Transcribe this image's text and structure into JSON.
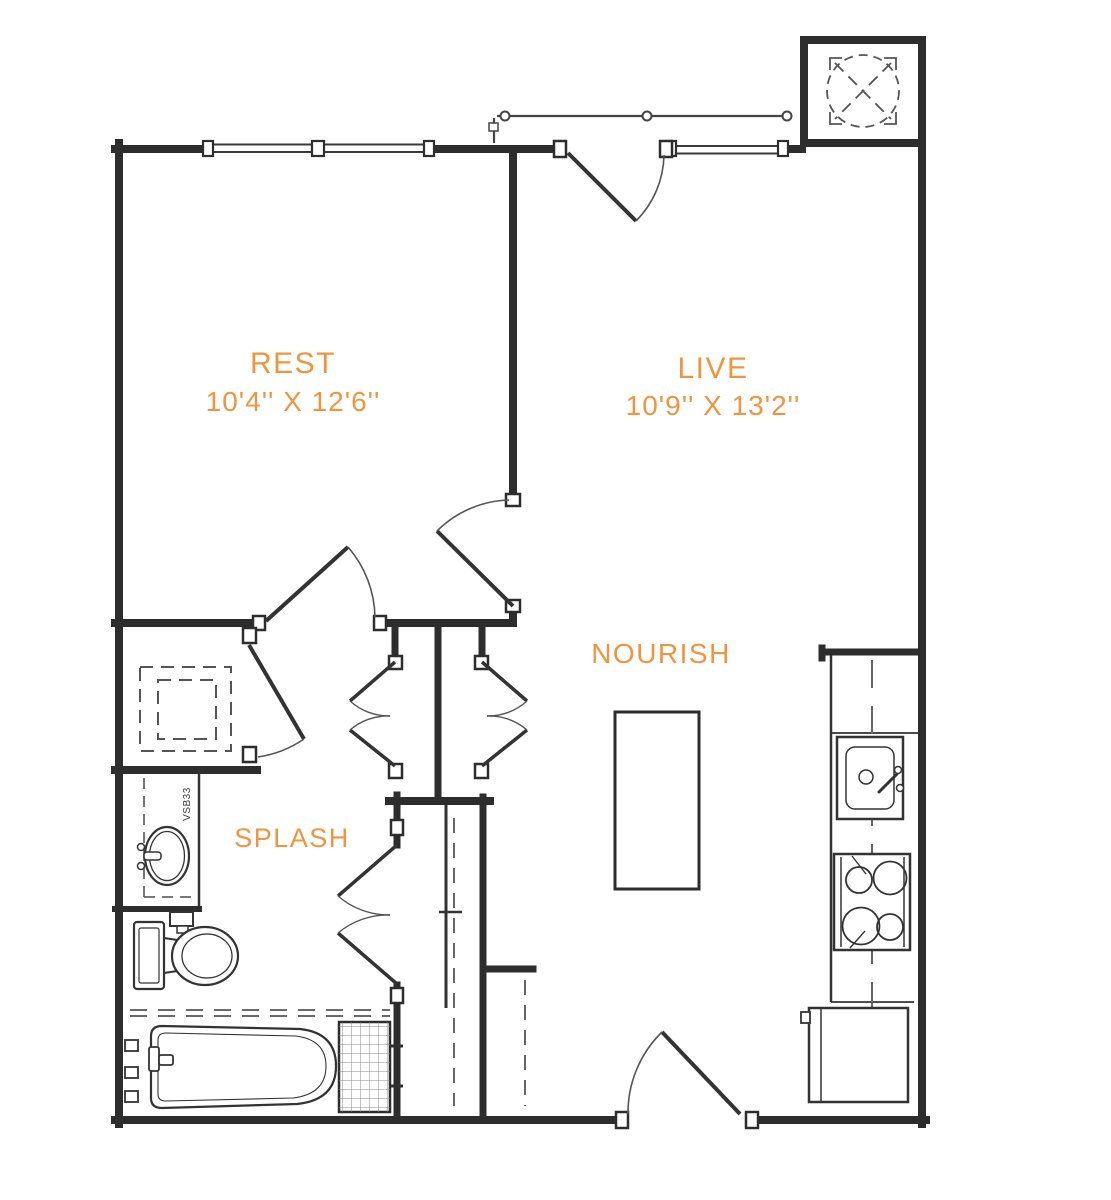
{
  "page": {
    "background": "#ffffff",
    "type": "apartment-floor-plan"
  },
  "palette": {
    "accent_orange": "#F0953F",
    "wall_black": "#2D2D2D",
    "detail_gray": "#555555"
  },
  "rooms": {
    "rest": {
      "label": "REST",
      "dimensions": "10'4'' X 12'6''"
    },
    "live": {
      "label": "LIVE",
      "dimensions": "10'9'' X 13'2''"
    },
    "nourish": {
      "label": "NOURISH"
    },
    "splash": {
      "label": "SPLASH"
    }
  },
  "annotations": {
    "vanity_model": "VSB33"
  },
  "fixtures": [
    "balcony-railing",
    "mechanical-shaft",
    "entry-door-top",
    "entry-door-bottom",
    "bedroom-door",
    "hall-door",
    "washer-dryer-closet",
    "closet-double-doors-west",
    "closet-double-doors-east",
    "bathroom-double-doors",
    "vanity-sink",
    "toilet",
    "bathtub",
    "shower-tile-niche",
    "kitchen-counter",
    "kitchen-sink",
    "range-cooktop",
    "refrigerator",
    "kitchen-island"
  ]
}
